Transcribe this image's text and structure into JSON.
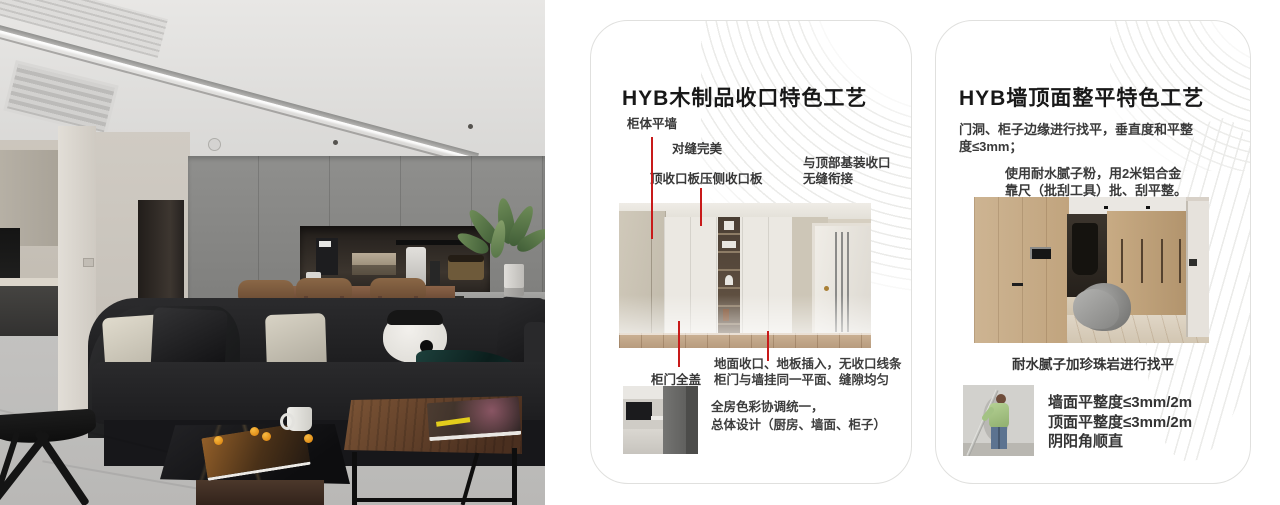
{
  "colors": {
    "leader_line_red": "#c81a1a",
    "card_border": "#e0e0de",
    "deco_line": "#ebebe9"
  },
  "cards": {
    "wood": {
      "title": "HYB木制品收口特色工艺",
      "labels": {
        "cabinet_flush_wall": "柜体平墙",
        "perfect_joint": "对缝完美",
        "top_closeout_board": "顶收口板压侧收口板",
        "ceiling_joint_line1": "与顶部基装收口",
        "ceiling_joint_line2": "无缝衔接",
        "full_cover_door": "柜门全盖"
      },
      "notes": {
        "floor_line1": "地面收口、地板插入，无收口线条",
        "floor_line2": "柜门与墙挂同一平面、缝隙均匀",
        "color_line1": "全房色彩协调统一，",
        "color_line2": "总体设计（厨房、墙面、柜子）"
      }
    },
    "wall": {
      "title": "HYB墙顶面整平特色工艺",
      "para1_line1": "门洞、柜子边缘进行找平，垂直度和平整",
      "para1_line2": "度≤3mm；",
      "para2_line1": "使用耐水腻子粉，用2米铝合金",
      "para2_line2": "靠尺（批刮工具）批、刮平整。",
      "caption": "耐水腻子加珍珠岩进行找平",
      "bullets": [
        "墙面平整度≤3mm/2m",
        "顶面平整度≤3mm/2m",
        "阴阳角顺直"
      ]
    }
  }
}
